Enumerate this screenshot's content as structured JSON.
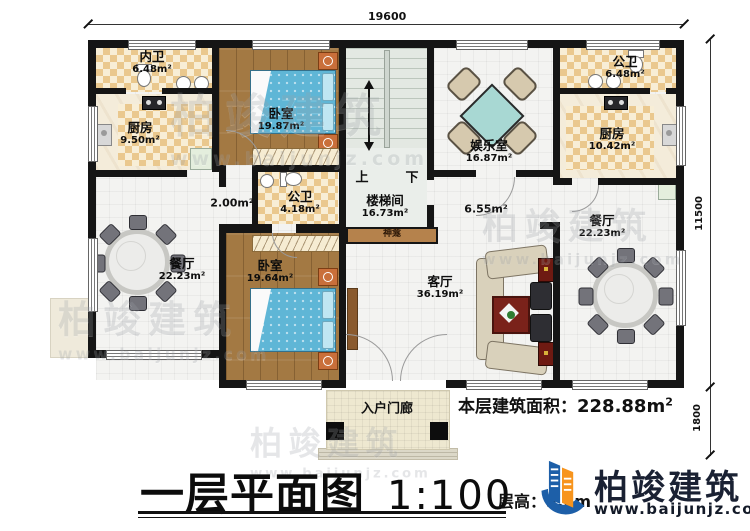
{
  "dims": {
    "top": "19600",
    "right": "11500",
    "right_lower": "1800"
  },
  "rooms": {
    "neiwei": {
      "name": "内卫",
      "area": "6.48m²"
    },
    "kitchen_left": {
      "name": "厨房",
      "area": "9.50m²"
    },
    "bedroom_top": {
      "name": "卧室",
      "area": "19.87m²"
    },
    "stairwell": {
      "name": "楼梯间",
      "area": "16.73m²"
    },
    "entertainment": {
      "name": "娱乐室",
      "area": "16.87m²"
    },
    "bathroom_top_right": {
      "name": "公卫",
      "area": "6.48m²"
    },
    "kitchen_right": {
      "name": "厨房",
      "area": "10.42m²"
    },
    "bathroom_mid": {
      "name": "公卫",
      "area": "4.18m²"
    },
    "dining_left": {
      "name": "餐厅",
      "area": "22.23m²"
    },
    "bedroom_bottom": {
      "name": "卧室",
      "area": "19.64m²"
    },
    "living": {
      "name": "客厅",
      "area": "36.19m²"
    },
    "dining_right": {
      "name": "餐厅",
      "area": "22.23m²"
    }
  },
  "annotations": {
    "corridor_area": "2.00m²",
    "hall_area": "6.55m²",
    "shrine": "神龛",
    "porch": "入户门廊",
    "up": "上",
    "down": "下"
  },
  "summary": {
    "area_label": "本层建筑面积：",
    "area_value": "228.88m",
    "area_sup": "2",
    "floor_height_label": "层高：",
    "floor_height_value": "3.6m"
  },
  "title": {
    "plan_name": "一层平面图",
    "scale": "1:100"
  },
  "brand": {
    "name": "柏竣建筑",
    "website": "www.baijunjz.com"
  }
}
